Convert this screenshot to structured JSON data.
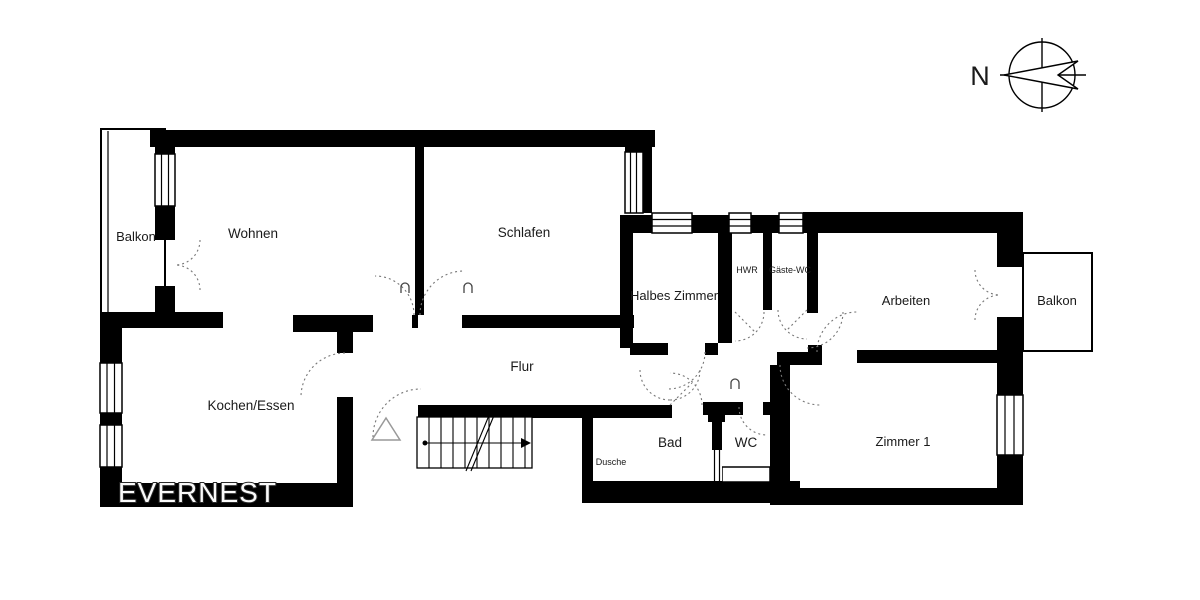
{
  "brand": {
    "name": "EVERNEST"
  },
  "compass": {
    "label": "N",
    "direction": "north-points-left"
  },
  "rooms": {
    "balkon_left": {
      "label": "Balkon"
    },
    "wohnen": {
      "label": "Wohnen"
    },
    "schlafen": {
      "label": "Schlafen"
    },
    "halbes_zimmer": {
      "label": "Halbes Zimmer"
    },
    "hwr": {
      "label": "HWR"
    },
    "gaeste_wc": {
      "label": "Gäste-WC"
    },
    "arbeiten": {
      "label": "Arbeiten"
    },
    "balkon_right": {
      "label": "Balkon"
    },
    "kochen_essen": {
      "label": "Kochen/Essen"
    },
    "flur": {
      "label": "Flur"
    },
    "dusche": {
      "label": "Dusche"
    },
    "bad": {
      "label": "Bad"
    },
    "wc": {
      "label": "WC"
    },
    "zimmer_1": {
      "label": "Zimmer 1"
    }
  },
  "colors": {
    "wall": "#000000",
    "background": "#ffffff",
    "door_arc": "#777777",
    "label": "#1a1a1a"
  }
}
